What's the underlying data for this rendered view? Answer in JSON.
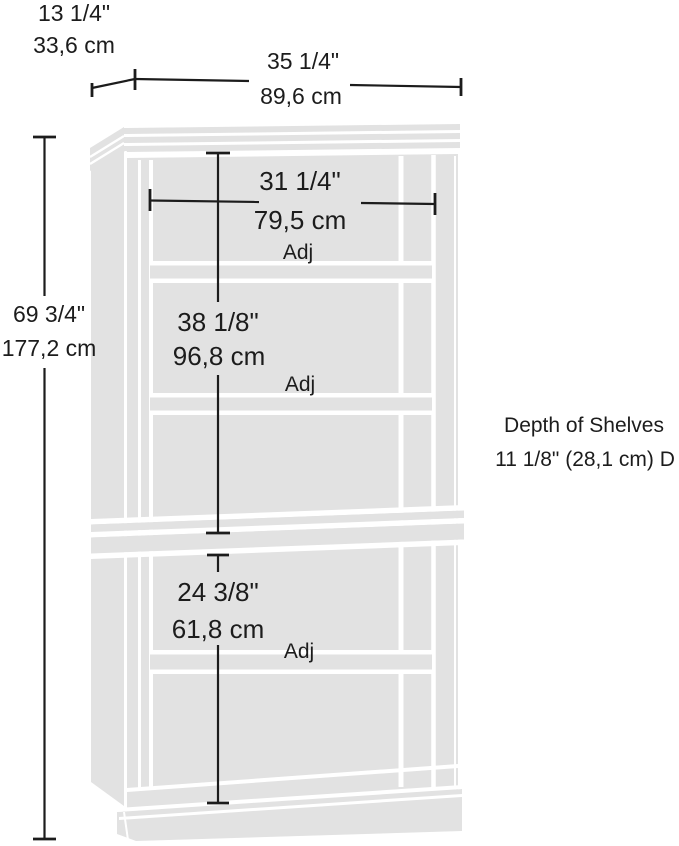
{
  "colors": {
    "cabinet_fill": "#e2e2e2",
    "line": "#1c1c1c",
    "background": "#ffffff"
  },
  "annotations": {
    "depth": {
      "inches": "13 1/4\"",
      "cm": "33,6 cm"
    },
    "width": {
      "inches": "35 1/4\"",
      "cm": "89,6 cm"
    },
    "height": {
      "inches": "69 3/4\"",
      "cm": "177,2 cm"
    },
    "interior_width": {
      "inches": "31 1/4\"",
      "cm": "79,5 cm"
    },
    "upper_section_height": {
      "inches": "38 1/8\"",
      "cm": "96,8 cm"
    },
    "lower_section_height": {
      "inches": "24 3/8\"",
      "cm": "61,8 cm"
    },
    "shelves": [
      {
        "label": "Adj"
      },
      {
        "label": "Adj"
      },
      {
        "label": "Adj"
      }
    ],
    "depth_note": {
      "line1": "Depth of Shelves",
      "line2": "11 1/8\" (28,1 cm) D"
    }
  }
}
